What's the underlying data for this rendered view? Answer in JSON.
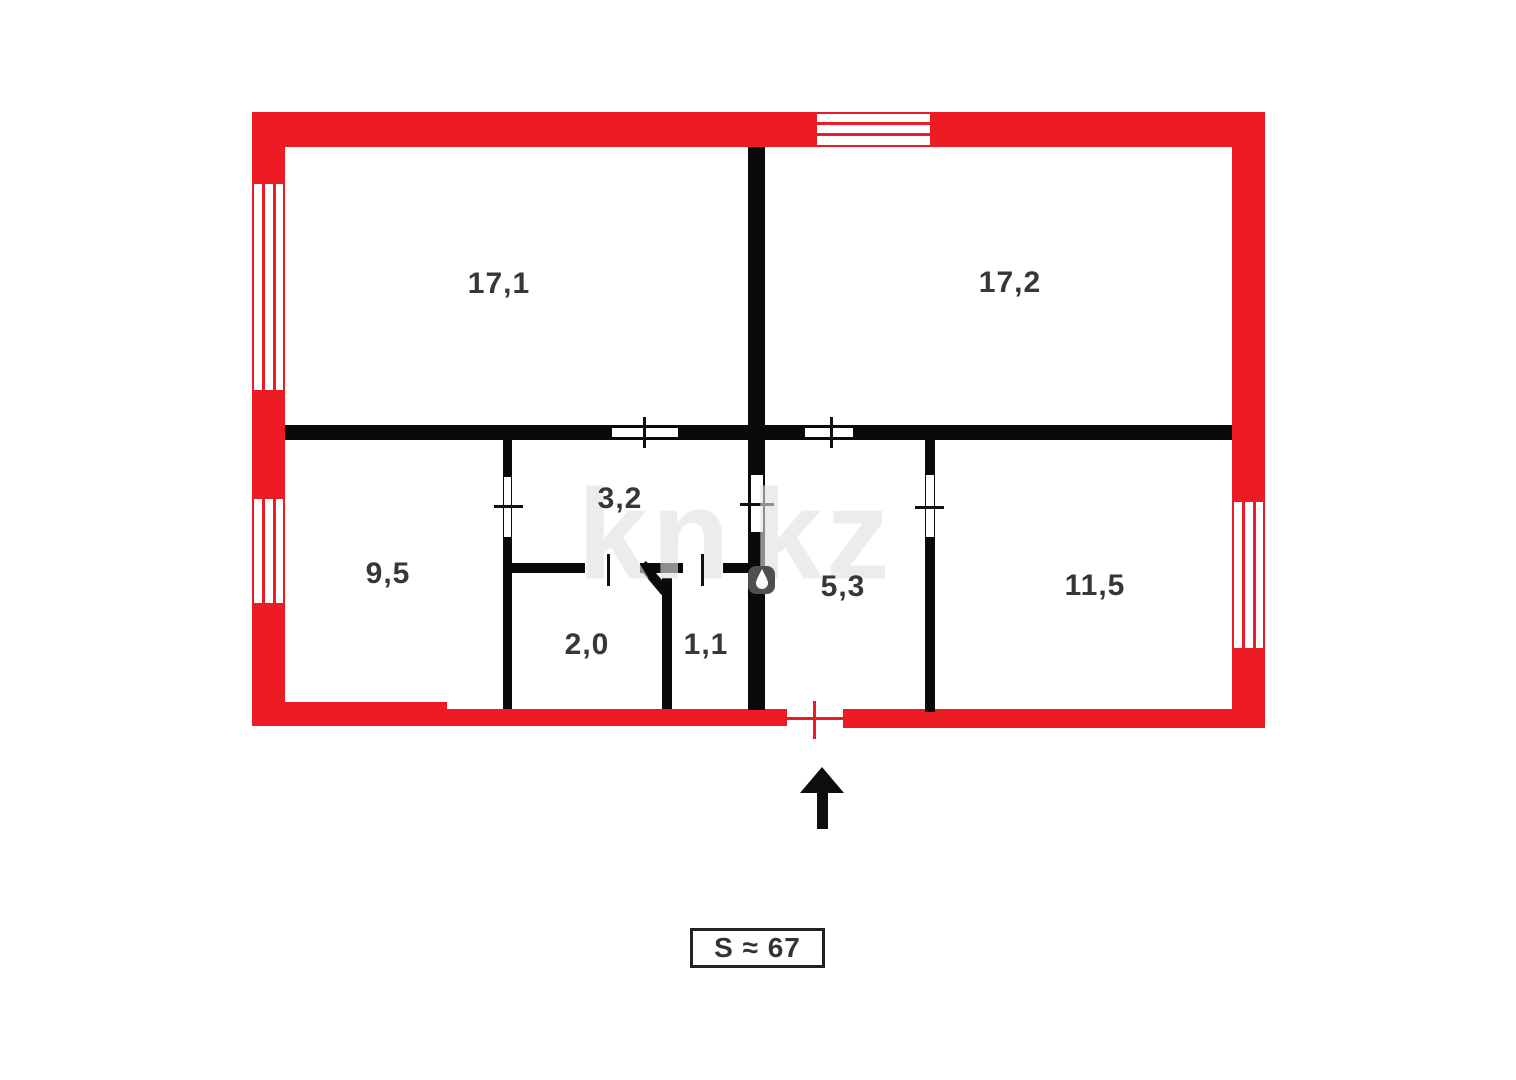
{
  "plan": {
    "rooms": [
      {
        "name": "room-17-1",
        "area": "17,1"
      },
      {
        "name": "room-17-2",
        "area": "17,2"
      },
      {
        "name": "room-9-5",
        "area": "9,5"
      },
      {
        "name": "room-3-2",
        "area": "3,2"
      },
      {
        "name": "room-2-0",
        "area": "2,0"
      },
      {
        "name": "room-1-1",
        "area": "1,1"
      },
      {
        "name": "room-5-3",
        "area": "5,3"
      },
      {
        "name": "room-11-5",
        "area": "11,5"
      }
    ],
    "total_area_label": "S ≈ 67"
  },
  "watermark": {
    "left": "kn",
    "right": "kz"
  },
  "colors": {
    "wall_red": "#ed1c24",
    "wall_black": "#0a0a0a",
    "room_label_text": "#373737",
    "watermark_gray": "#e0e0e0"
  }
}
